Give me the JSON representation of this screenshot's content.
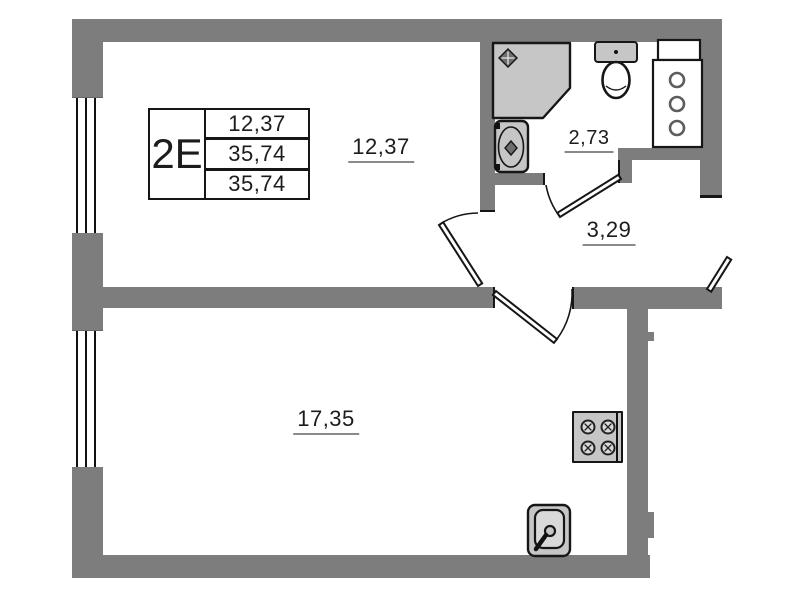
{
  "title_block": {
    "unit_label": "2Е",
    "values": [
      "12,37",
      "35,74",
      "35,74"
    ]
  },
  "areas": {
    "upper_room": "12,37",
    "bathroom": "2,73",
    "hallway": "3,29",
    "lower_room": "17,35"
  },
  "icons": [
    "shower-icon",
    "wash-basin-icon",
    "toilet-icon",
    "ventilation-shaft",
    "stove-icon",
    "kitchen-sink-icon",
    "window-symbol",
    "door-swing-symbol"
  ],
  "colors": {
    "wall": "#7d7d7d",
    "outline": "#161616",
    "fixture": "#c6c6c6",
    "fixture2": "#d9d9d9",
    "text": "#1c1c1c",
    "underline": "#8a8a8a"
  }
}
